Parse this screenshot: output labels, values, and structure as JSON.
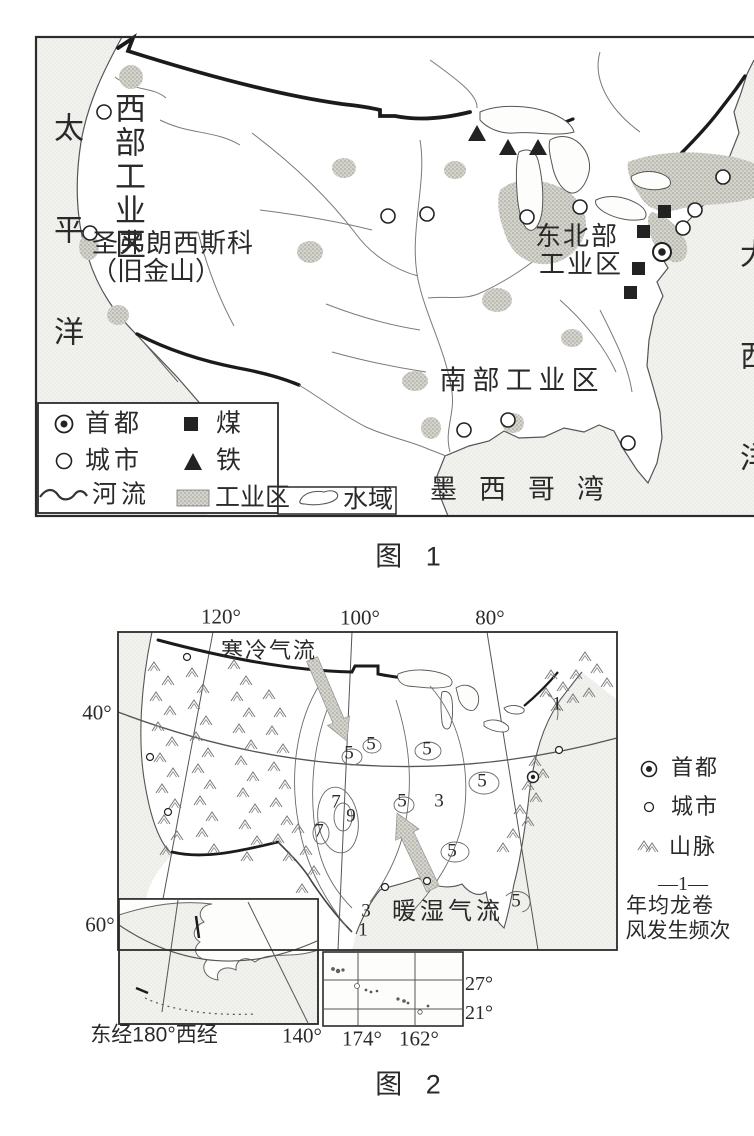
{
  "colors": {
    "ink": "#2a2a2a",
    "coast_line": "#555555",
    "thick_border": "#1b1b1b",
    "ocean_stipple": "#f1f1ee",
    "industrial_patch": "#c9c9c3"
  },
  "map1": {
    "caption": "图 1",
    "labels": {
      "pacific": "太平洋",
      "atlantic": "大西洋",
      "gulf": "墨西哥湾",
      "west_zone": "西部工业区",
      "northeast_zone_line1": "东北部",
      "northeast_zone_line2": "工业区",
      "south_zone": "南部工业区",
      "san_francisco_line1": "圣弗朗西斯科",
      "san_francisco_line2": "（旧金山）"
    },
    "legend": {
      "capital": "首都",
      "city": "城市",
      "river": "河流",
      "coal": "煤",
      "iron": "铁",
      "industrial_zone": "工业区",
      "water_area": "水域"
    }
  },
  "map2": {
    "caption": "图 2",
    "labels": {
      "cold_current": "寒冷气流",
      "warm_current": "暖湿气流"
    },
    "axis": {
      "lon_120": "120°",
      "lon_100": "100°",
      "lon_80": "80°",
      "lat_40": "40°",
      "lat_60": "60°",
      "alaska_lon": "东经180°西经",
      "lon_140": "140°",
      "lon_174": "174°",
      "lon_162": "162°",
      "lat_27": "27°",
      "lat_21": "21°"
    },
    "contours": [
      "5",
      "5",
      "5",
      "5",
      "5",
      "5",
      "5",
      "3",
      "7",
      "9",
      "7",
      "3",
      "1",
      "1"
    ],
    "legend": {
      "capital": "首都",
      "city": "城市",
      "mountains": "山脉",
      "freq_symbol": "—1—",
      "freq_line1": "年均龙卷",
      "freq_line2": "风发生频次"
    }
  }
}
